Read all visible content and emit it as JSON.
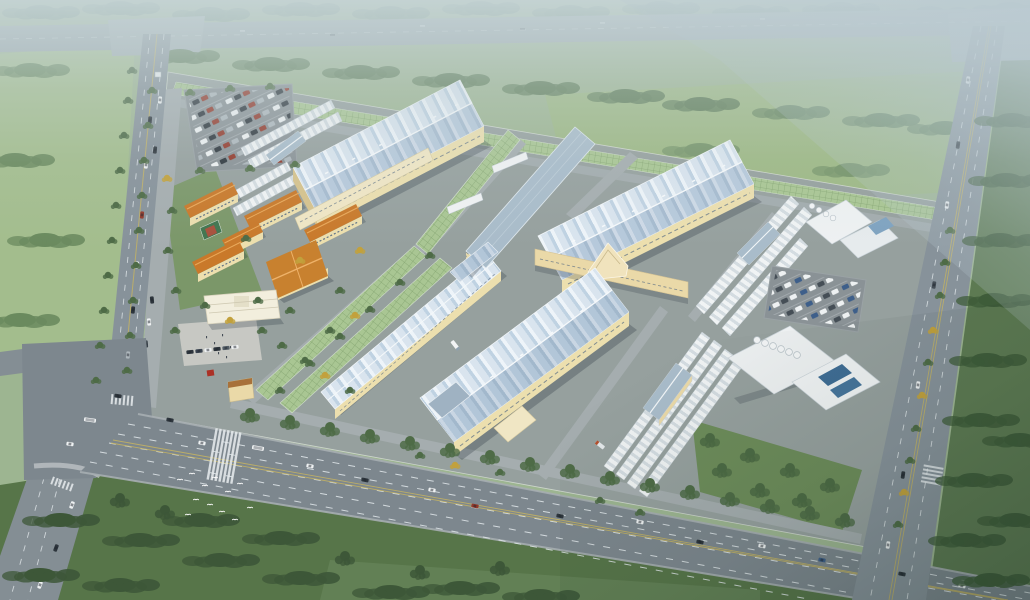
{
  "scene": {
    "type": "aerial-architectural-rendering",
    "subject": "industrial park factory campus master plan",
    "view": "bird's-eye perspective, hazy horizon at top, warm afternoon light",
    "surroundings": "highway along top edge, tree-lined arterial roads on left / right / bottom, forest band and meadow to the north, dark forest to the south-east, large lawn with bird flock at bottom"
  },
  "campus": {
    "production_halls": 3,
    "long_workshop": 1,
    "office_slab_building": 1,
    "connector_hall_with_pediment": 1,
    "dormitory_blocks": 5,
    "canteen_building": 1,
    "admin_building_with_plaza": 1,
    "gatehouse": 1,
    "warehouse_row_clusters": 4,
    "utility_plants": 2,
    "greenhouse_canopy_strips": 4,
    "parking_lots": 2,
    "basketball_court": 1,
    "bird_flock": 1
  },
  "palette": {
    "base": "#9db591",
    "mist": "#c7d5d8",
    "mistTR": "#b9c9d1",
    "highway": "#98a5a9",
    "field": "#a3bd8d",
    "meadow": "#9db884",
    "forestFar": "#73907c",
    "forest": "#4e6b46",
    "forestDark": "#3d5738",
    "lawnBottom": "#577549",
    "lawnBright": "#648257",
    "lawnCampus": "#7b9769",
    "lawnSE": "#6d8c5a",
    "roadMain": "#7d878e",
    "roadSide": "#87929a",
    "roadInner": "#a5adaf",
    "campusGround": "#96a09e",
    "plaza": "#c7c8c3",
    "laneWhite": "#e3e9ec",
    "laneYellow": "#c3b263",
    "ribLight": "#d9e4ee",
    "ribDark": "#b6c9db",
    "roofFlat": "#a9bcca",
    "wallCream": "#ecdfae",
    "wallShade": "#d6c28c",
    "windowDark": "#5f7286",
    "glassGreen": "#a9c693",
    "glassGrid": "#84a470",
    "roofOrange": "#c9792a",
    "roofOrangeLight": "#e9a95a",
    "courtGreen": "#41754f",
    "courtRed": "#a8503c",
    "poolBlue": "#3f6d95",
    "tankWhite": "#f3f5f6",
    "parkAsphalt": "#8a9296",
    "carWhite": "#eef1f2",
    "carDark": "#2e363d",
    "carRed": "#93392b",
    "carSilver": "#aeb7bc",
    "birdWhite": "#ffffff"
  }
}
